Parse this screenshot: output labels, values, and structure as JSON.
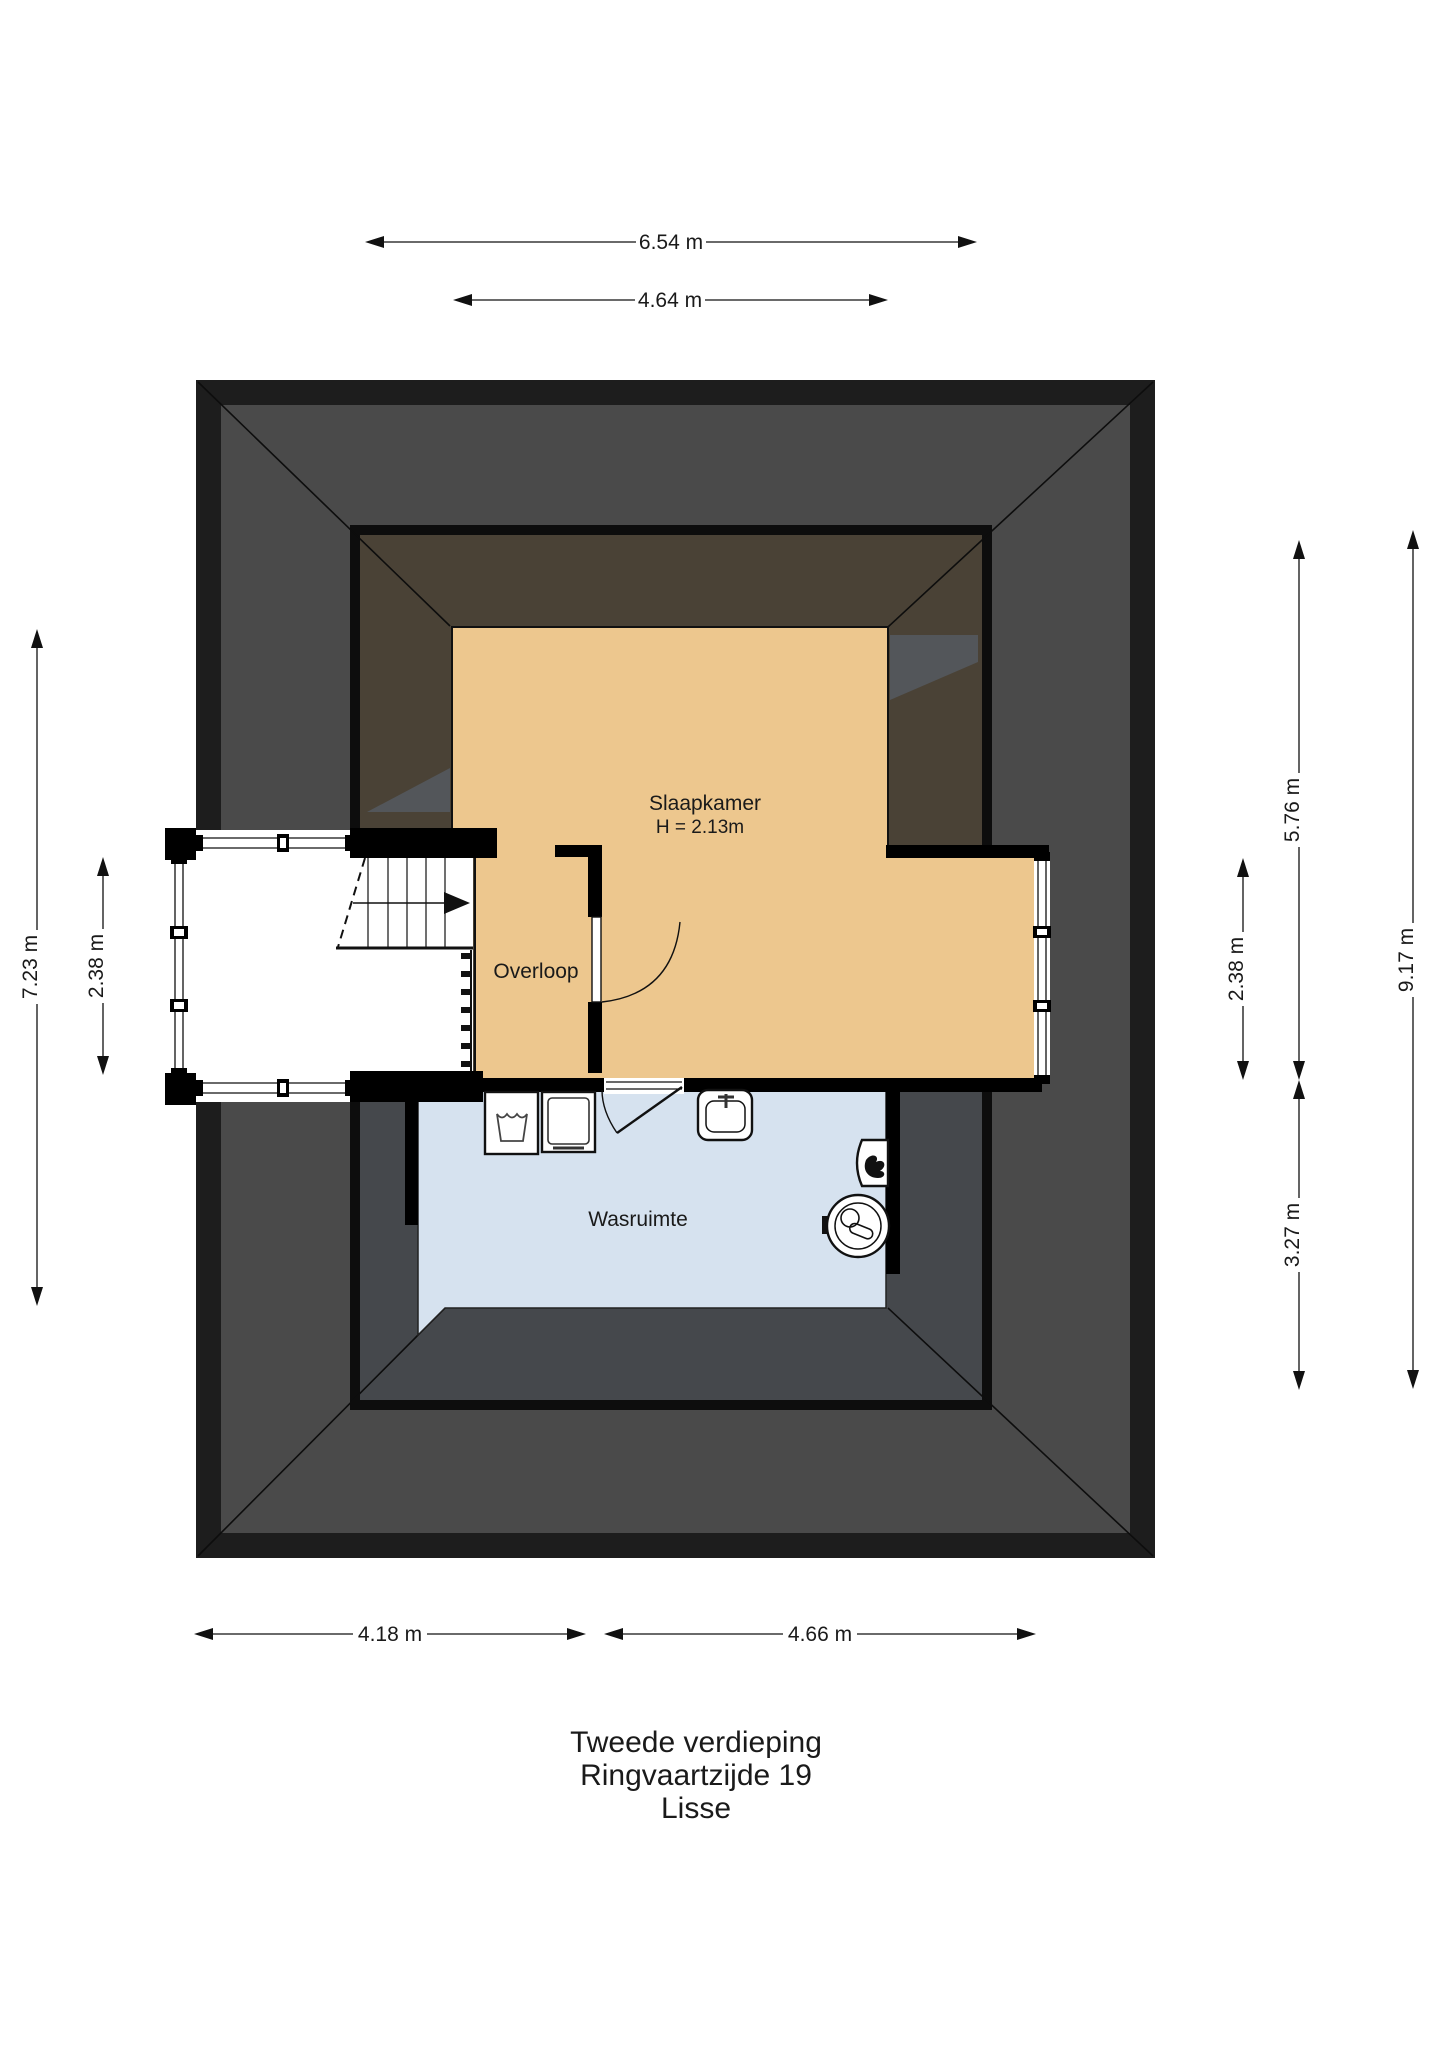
{
  "title": {
    "line1": "Tweede verdieping",
    "line2": "Ringvaartzijde 19",
    "line3": "Lisse"
  },
  "rooms": {
    "bedroom_label": "Slaapkamer",
    "bedroom_height_note": "H = 2.13m",
    "landing_label": "Overloop",
    "laundry_label": "Wasruimte"
  },
  "dimensions": {
    "top_outer": "6.54 m",
    "top_inner": "4.64 m",
    "bottom_left": "4.18 m",
    "bottom_right": "4.66 m",
    "left_outer": "7.23 m",
    "left_inner": "2.38 m",
    "right_inner": "2.38 m",
    "right_mid": "5.76 m",
    "right_lower": "3.27 m",
    "right_outer": "9.17 m"
  },
  "icons": [
    "stairs-direction-arrow-icon",
    "laundry-tub-icon",
    "washing-machine-icon",
    "sink-icon",
    "flame-heater-icon",
    "boiler-icon",
    "door-swing-icon"
  ],
  "colors": {
    "roof_band": "#1d1d1d",
    "roof_gray": "#4a4a4a",
    "roof_inner_brown": "#4a4236",
    "attic_gray": "#45484c",
    "room_orange": "#edc78e",
    "laundry_blue": "#d6e2ef"
  }
}
